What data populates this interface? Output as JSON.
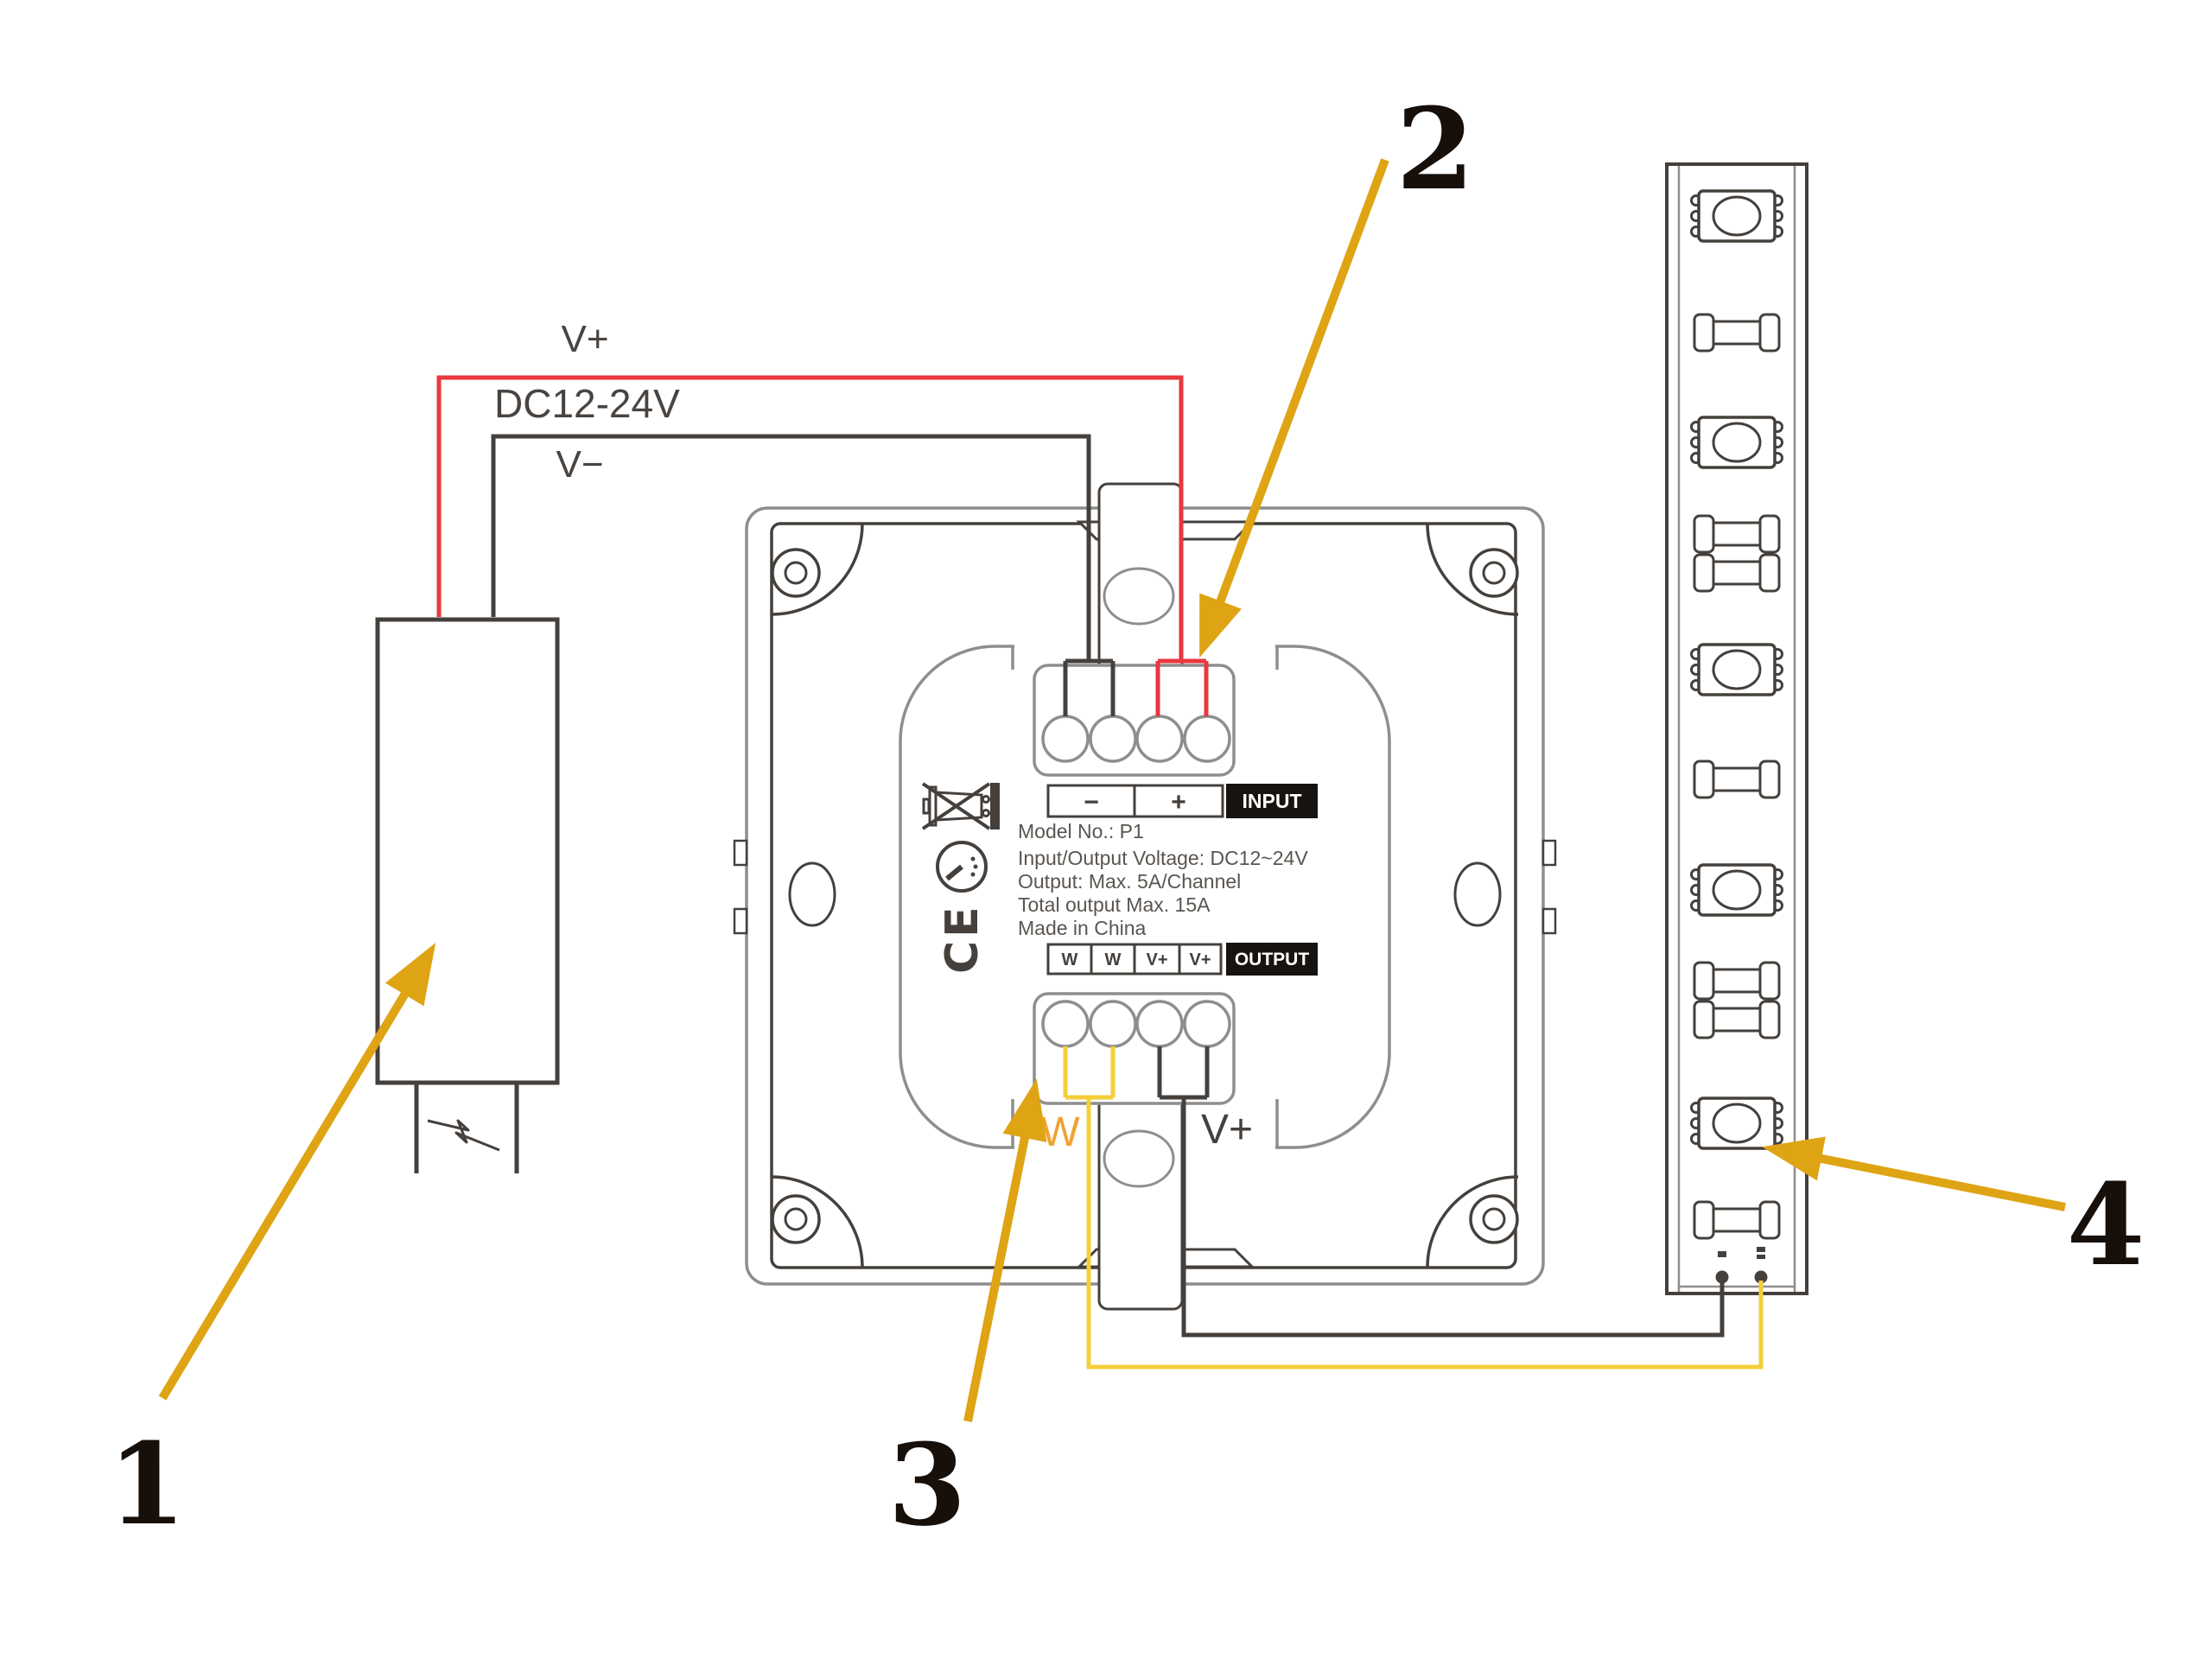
{
  "callouts": {
    "n1": "1",
    "n2": "2",
    "n3": "3",
    "n4": "4"
  },
  "wires": {
    "v_plus": "V+",
    "supply_voltage": "DC12-24V",
    "v_minus": "V−"
  },
  "output_wires": {
    "w": "W",
    "v_plus": "V+"
  },
  "panel": {
    "input": {
      "minus": "−",
      "plus": "+",
      "label": "INPUT"
    },
    "output": {
      "t0": "W",
      "t1": "W",
      "t2": "V+",
      "t3": "V+",
      "label": "OUTPUT"
    },
    "specs": {
      "model": "Model No.: P1",
      "voltage": "Input/Output Voltage: DC12~24V",
      "output": "Output: Max. 5A/Channel",
      "total": "Total output Max. 15A",
      "origin": "Made in China"
    },
    "ce_mark": "CE"
  },
  "colors": {
    "red_wire": "#e8373d",
    "dark_wire": "#45403c",
    "yellow_wire": "#f3cf3a",
    "arrow_amber": "#dfa414",
    "panel_gray": "#8e8e8e",
    "label_orange": "#f0a22e"
  }
}
